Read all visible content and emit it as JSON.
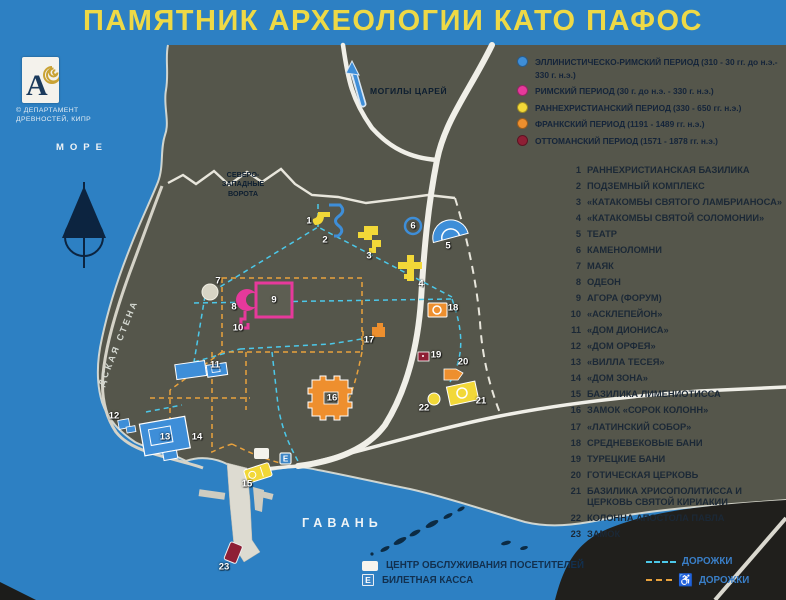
{
  "title": "ПАМЯТНИК АРХЕОЛОГИИ КАТО ПАФОС",
  "logo": {
    "monogram": "A",
    "caption_line1": "© ДЕПАРТАМЕНТ",
    "caption_line2": "ДРЕВНОСТЕЙ, КИПР"
  },
  "colors": {
    "board_blue": "#2d80c3",
    "land": "#55564b",
    "road": "#f0efe8",
    "title_yellow": "#eed946",
    "hellenistic_roman": "#3e8ed8",
    "roman": "#e6399b",
    "early_christian": "#f2d838",
    "frankish": "#ee8f2e",
    "ottoman": "#8e1f35",
    "path_cyan": "#4cc8e9",
    "path_orange": "#e9a23d"
  },
  "periods_legend": [
    {
      "label": "ЭЛЛИНИСТИЧЕСКО-РИМСКИЙ ПЕРИОД",
      "dates": "(310 - 30 гг. до н.э.- 330 г. н.э.)",
      "color": "#3e8ed8"
    },
    {
      "label": "РИМСКИЙ ПЕРИОД",
      "dates": "(30 г. до н.э. - 330 г. н.э.)",
      "color": "#e6399b"
    },
    {
      "label": "РАННЕХРИСТИАНСКИЙ ПЕРИОД",
      "dates": "(330 - 650 гг. н.э.)",
      "color": "#f2d838"
    },
    {
      "label": "ФРАНКСКИЙ ПЕРИОД",
      "dates": "(1191 - 1489 гг. н.э.)",
      "color": "#ee8f2e"
    },
    {
      "label": "ОТТОМАНСКИЙ ПЕРИОД",
      "dates": "(1571 - 1878 гг. н.э.)",
      "color": "#8e1f35"
    }
  ],
  "sites": [
    {
      "num": 1,
      "label": "РАННЕХРИСТИАНСКАЯ БАЗИЛИКА"
    },
    {
      "num": 2,
      "label": "ПОДЗЕМНЫЙ КОМПЛЕКС"
    },
    {
      "num": 3,
      "label": "«КАТАКОМБЫ СВЯТОГО ЛАМБРИАНОСА»"
    },
    {
      "num": 4,
      "label": "«КАТАКОМБЫ СВЯТОЙ СОЛОМОНИИ»"
    },
    {
      "num": 5,
      "label": "ТЕАТР"
    },
    {
      "num": 6,
      "label": "КАМЕНОЛОМНИ"
    },
    {
      "num": 7,
      "label": "МАЯК"
    },
    {
      "num": 8,
      "label": "ОДЕОН"
    },
    {
      "num": 9,
      "label": "АГОРА (ФОРУМ)"
    },
    {
      "num": 10,
      "label": "«АСКЛЕПЕЙОН»"
    },
    {
      "num": 11,
      "label": "«ДОМ ДИОНИСА»"
    },
    {
      "num": 12,
      "label": "«ДОМ ОРФЕЯ»"
    },
    {
      "num": 13,
      "label": "«ВИЛЛА ТЕСЕЯ»"
    },
    {
      "num": 14,
      "label": "«ДОМ ЗОНА»"
    },
    {
      "num": 15,
      "label": "БАЗИЛИКА ЛИМЕНИОТИССА"
    },
    {
      "num": 16,
      "label": "ЗАМОК «СОРОК КОЛОНН»"
    },
    {
      "num": 17,
      "label": "«ЛАТИНСКИЙ СОБОР»"
    },
    {
      "num": 18,
      "label": "СРЕДНЕВЕКОВЫЕ БАНИ"
    },
    {
      "num": 19,
      "label": "ТУРЕЦКИЕ БАНИ"
    },
    {
      "num": 20,
      "label": "ГОТИЧЕСКАЯ ЦЕРКОВЬ"
    },
    {
      "num": 21,
      "label": "БАЗИЛИКА ХРИСОПОЛИТИССА И ЦЕРКОВЬ СВЯТОЙ КИРИАКИИ"
    },
    {
      "num": 22,
      "label": "КОЛОННА АПОСТОЛА ПАВЛА"
    },
    {
      "num": 23,
      "label": "ЗАМОК"
    }
  ],
  "map": {
    "labels": {
      "sea": "МОРЕ",
      "harbor": "ГАВАНЬ",
      "tombs_of_kings": "МОГИЛЫ ЦАРЕЙ",
      "nw_gate": "СЕВЕРО-\nЗАПАДНЫЕ\nВОРОТА",
      "city_wall": "ДСКАЯ СТЕНА"
    },
    "ticket_label": "E",
    "markers": [
      {
        "num": "1",
        "x": 309,
        "y": 221
      },
      {
        "num": "2",
        "x": 325,
        "y": 240
      },
      {
        "num": "3",
        "x": 369,
        "y": 256
      },
      {
        "num": "4",
        "x": 421,
        "y": 284
      },
      {
        "num": "5",
        "x": 448,
        "y": 246
      },
      {
        "num": "6",
        "x": 413,
        "y": 226
      },
      {
        "num": "7",
        "x": 218,
        "y": 281
      },
      {
        "num": "8",
        "x": 234,
        "y": 307
      },
      {
        "num": "9",
        "x": 274,
        "y": 300
      },
      {
        "num": "10",
        "x": 238,
        "y": 328
      },
      {
        "num": "11",
        "x": 215,
        "y": 365
      },
      {
        "num": "12",
        "x": 114,
        "y": 416
      },
      {
        "num": "13",
        "x": 165,
        "y": 437
      },
      {
        "num": "14",
        "x": 197,
        "y": 437
      },
      {
        "num": "15",
        "x": 247,
        "y": 484
      },
      {
        "num": "16",
        "x": 332,
        "y": 398
      },
      {
        "num": "17",
        "x": 369,
        "y": 340
      },
      {
        "num": "18",
        "x": 453,
        "y": 308
      },
      {
        "num": "19",
        "x": 436,
        "y": 355
      },
      {
        "num": "20",
        "x": 463,
        "y": 362
      },
      {
        "num": "21",
        "x": 481,
        "y": 401
      },
      {
        "num": "22",
        "x": 424,
        "y": 408
      },
      {
        "num": "23",
        "x": 224,
        "y": 567
      }
    ]
  },
  "facilities_legend": [
    {
      "icon": "white-square",
      "label": "ЦЕНТР ОБСЛУЖИВАНИЯ ПОСЕТИТЕЛЕЙ"
    },
    {
      "icon": "ticket-e",
      "label": "БИЛЕТНАЯ КАССА"
    }
  ],
  "paths_legend": [
    {
      "style": "cyan-dashed",
      "label": "ДОРОЖКИ"
    },
    {
      "style": "orange-dashed-accessible",
      "label": "ДОРОЖКИ"
    }
  ]
}
